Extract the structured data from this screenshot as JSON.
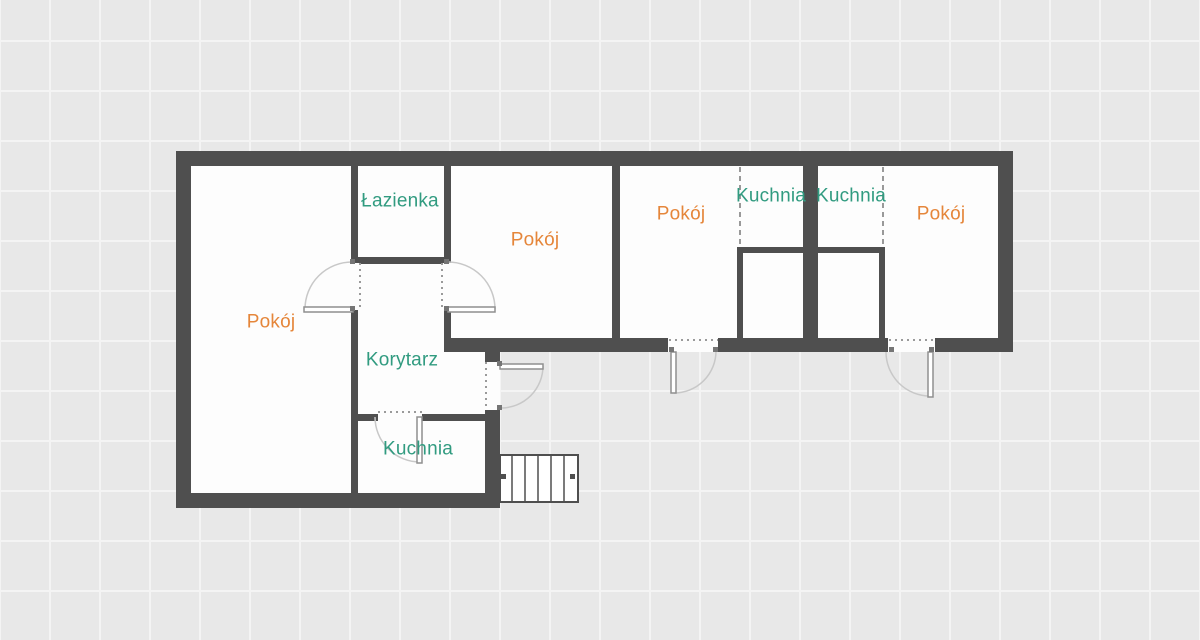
{
  "plan_title": "Rzut mieszkania",
  "colors": {
    "background": "#e8e8e8",
    "grid_line": "#f4f4f4",
    "wall": "#4f4f4f",
    "room_fill": "#fdfdfd",
    "label_room": "#e5863a",
    "label_service": "#319b80",
    "door_arc": "#c8c8c8",
    "door_leaf": "#8f8f8f",
    "door_frame": "#9a9a9a",
    "dashed_line": "#999999",
    "hinge": "#757575",
    "stairs_line": "#4f4f4f"
  },
  "rooms": [
    {
      "id": "pokoj-left",
      "label": "Pokój",
      "type": "room"
    },
    {
      "id": "lazienka",
      "label": "Łazienka",
      "type": "service"
    },
    {
      "id": "pokoj-middle",
      "label": "Pokój",
      "type": "room"
    },
    {
      "id": "pokoj-second",
      "label": "Pokój",
      "type": "room"
    },
    {
      "id": "kuchnia-middle",
      "label": "Kuchnia",
      "type": "service"
    },
    {
      "id": "kuchnia-right",
      "label": "Kuchnia",
      "type": "service"
    },
    {
      "id": "pokoj-right",
      "label": "Pokój",
      "type": "room"
    },
    {
      "id": "korytarz",
      "label": "Korytarz",
      "type": "service"
    },
    {
      "id": "kuchnia-left",
      "label": "Kuchnia",
      "type": "service"
    }
  ]
}
